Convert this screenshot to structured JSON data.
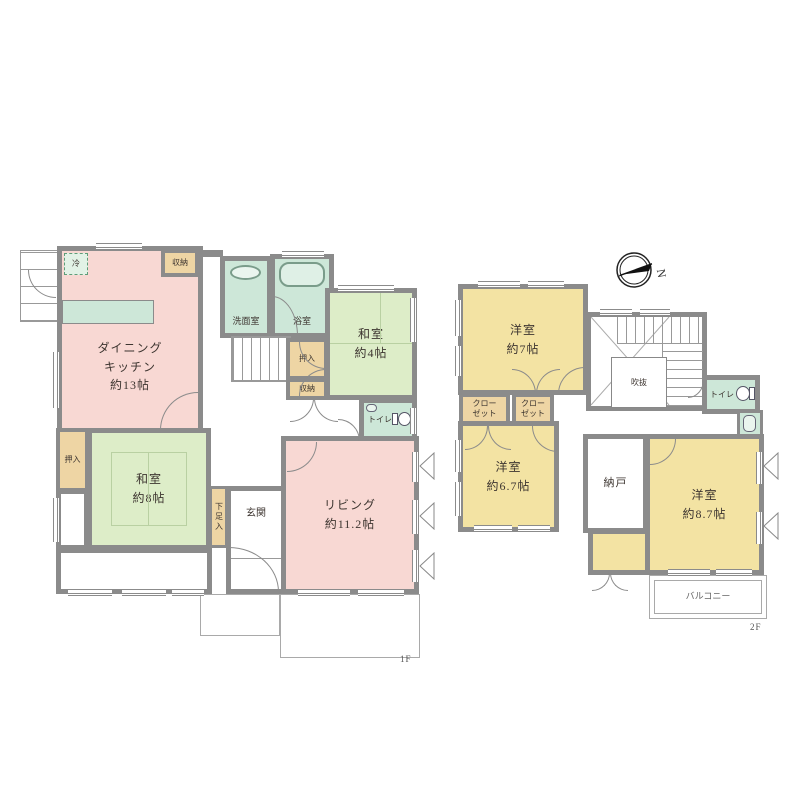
{
  "meta": {
    "type": "japanese-residential-floor-plan",
    "floors": 2
  },
  "colors": {
    "wall": "#8b8b8b",
    "room_pink": "#f8d8d3",
    "room_tatami_green": "#ddedc8",
    "room_bath_green": "#cde7d8",
    "room_yellow": "#f3e3a3",
    "closet_tan": "#eed5a4"
  },
  "floor1": {
    "label": "1F",
    "dining_kitchen": "ダイニング\nキッチン\n約13帖",
    "fridge": "冷",
    "storage_top": "収納",
    "washroom": "洗面室",
    "bathroom": "浴室",
    "washitsu_4": "和室\n約4帖",
    "oshiire_mid": "押入",
    "storage_mid": "収納",
    "toilet": "トイレ",
    "washitsu_8": "和室\n約8帖",
    "oshiire_left": "押入",
    "shoe_box": "下足入",
    "entrance": "玄関",
    "living": "リビング\n約11.2帖"
  },
  "floor2": {
    "label": "2F",
    "compass_north": "N",
    "western_7": "洋室\n約7帖",
    "closet_a": "クロー\nゼット",
    "closet_b": "クロー\nゼット",
    "atrium": "吹抜",
    "toilet": "トイレ",
    "western_67": "洋室\n約6.7帖",
    "storage_room": "納戸",
    "western_87": "洋室\n約8.7帖",
    "balcony": "バルコニー"
  }
}
